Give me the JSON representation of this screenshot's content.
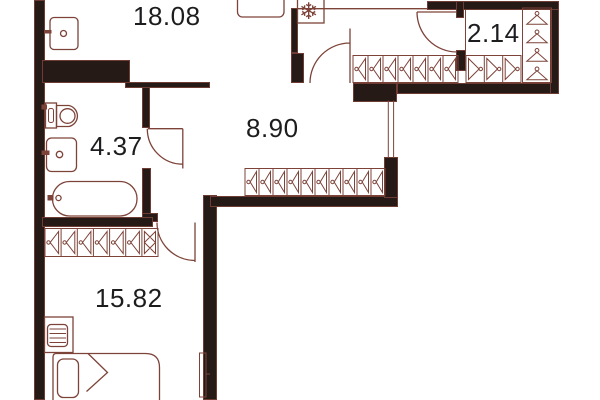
{
  "type": "apartment-floor-plan",
  "rooms": [
    {
      "name": "living-kitchen",
      "area": "18.08"
    },
    {
      "name": "entry-closet",
      "area": "2.14"
    },
    {
      "name": "bathroom",
      "area": "4.37"
    },
    {
      "name": "hallway",
      "area": "8.90"
    },
    {
      "name": "bedroom",
      "area": "15.82"
    }
  ],
  "fixtures": [
    "kitchen-sink",
    "kitchen-counter",
    "fridge",
    "wash-basin",
    "toilet",
    "bathtub",
    "wardrobe-hatch-rows",
    "coat-hangers",
    "bed",
    "pillow",
    "desk",
    "chair",
    "radiator",
    "interior-doors",
    "entrance-door",
    "duct-shaft"
  ],
  "icons": {
    "fridge": "snowflake ❄",
    "wardrobe_cell": "triangle-with-knob",
    "closet_rod": "coat-hanger",
    "door_swing": "quarter-circle-arc"
  },
  "colors": {
    "wall": "#251a16",
    "line": "#7d4339",
    "label": "#1d1d1f",
    "background": "#ffffff"
  }
}
